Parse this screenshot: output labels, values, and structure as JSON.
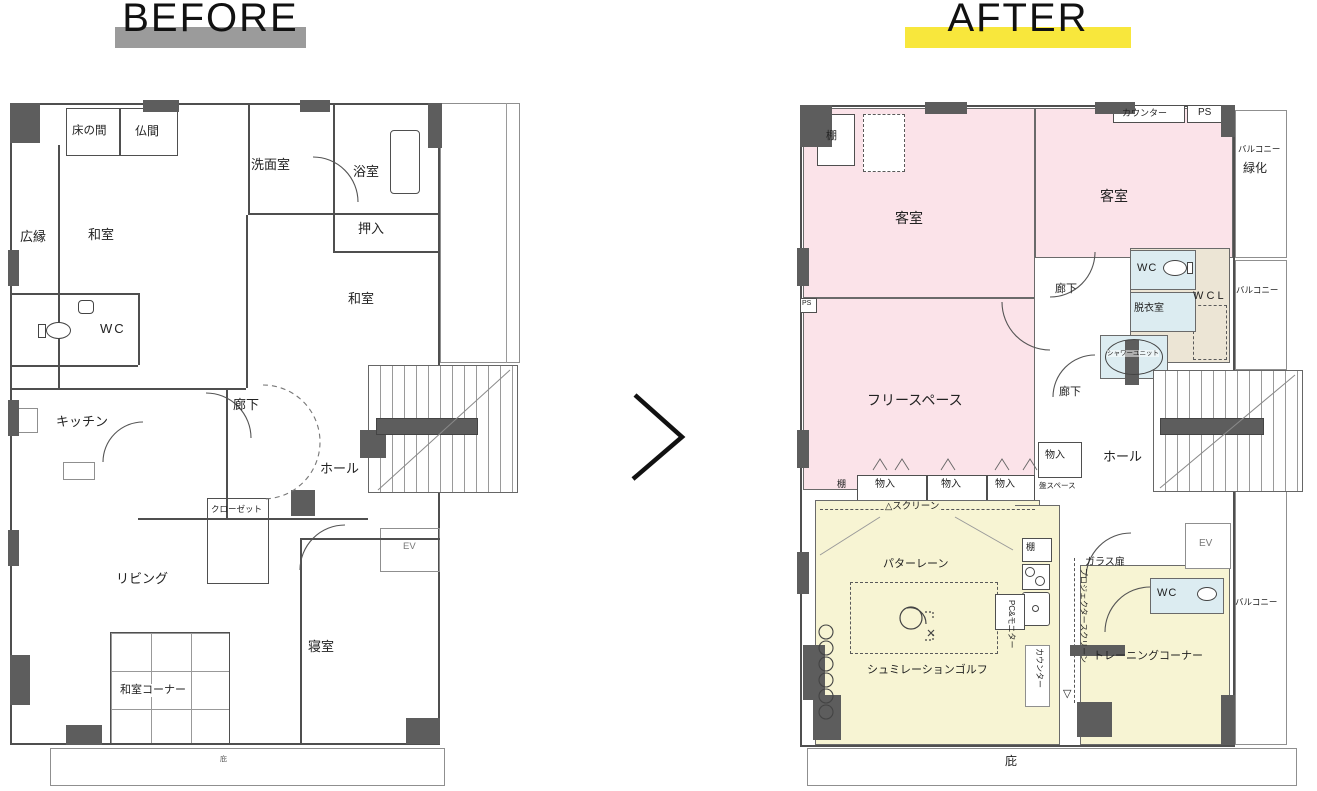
{
  "header": {
    "before": "BEFORE",
    "after": "AFTER"
  },
  "icons": {
    "arrow": "chevron-right",
    "toilet": "toilet-bowl",
    "stove": "stove-burners",
    "sink": "kitchen-sink",
    "bathtub": "bathtub",
    "shower": "shower-unit",
    "golfer": "golf-swing-figure",
    "stools": "stool-row",
    "crossbox": "equipment-box"
  },
  "colors": {
    "highlight_before": "#9b9b9b",
    "highlight_after": "#f8e73c",
    "room_pink": "#fbe3e9",
    "room_yellow": "#f7f4d3",
    "room_blue": "#dcecf1",
    "room_beige": "#ece5d5",
    "wall": "#5d5d5d"
  },
  "before": {
    "tokonoma": "床の間",
    "butsuma": "仏間",
    "washroom": "洗面室",
    "bathroom": "浴室",
    "hiroen": "広縁",
    "washitsu": "和室",
    "oshiire": "押入",
    "washitsu2": "和室",
    "wc": "WC",
    "kitchen": "キッチン",
    "corridor": "廊下",
    "hall": "ホール",
    "closet": "クローゼット",
    "elevator": "EV",
    "living": "リビング",
    "bedroom": "寝室",
    "washitsu_corner": "和室コーナー",
    "eaves": "庇"
  },
  "after": {
    "shelf_top": "棚",
    "guest1": "客室",
    "guest2": "客室",
    "counter_top": "カウンター",
    "ps_top": "PS",
    "balcony_top": "バルコニー",
    "greening": "緑化",
    "corridor1": "廊下",
    "wc1": "WC",
    "dressing": "脱衣室",
    "wcl": "W C L",
    "balcony_mid": "バルコニー",
    "shower": "シャワーユニット",
    "ps_left": "PS",
    "free_space": "フリースペース",
    "corridor2": "廊下",
    "storage_right": "物入",
    "panel_space": "盤スペース",
    "hall": "ホール",
    "shelf_row": "棚",
    "storage1": "物入",
    "storage2": "物入",
    "storage3": "物入",
    "screen": "△スクリーン",
    "shelf_mid": "棚",
    "putter_lane": "パターレーン",
    "glass_door": "ガラス扉",
    "elevator": "EV",
    "wc2": "WC",
    "balcony_bottom": "バルコニー",
    "simulation_golf": "シュミレーションゴルフ",
    "counter_side": "カウンター",
    "pc_monitor": "PC&モニター",
    "projector_marker": "▽",
    "projector_screen": "プロジェクタースクリーン",
    "training_corner": "トレーニングコーナー",
    "eaves": "庇"
  }
}
